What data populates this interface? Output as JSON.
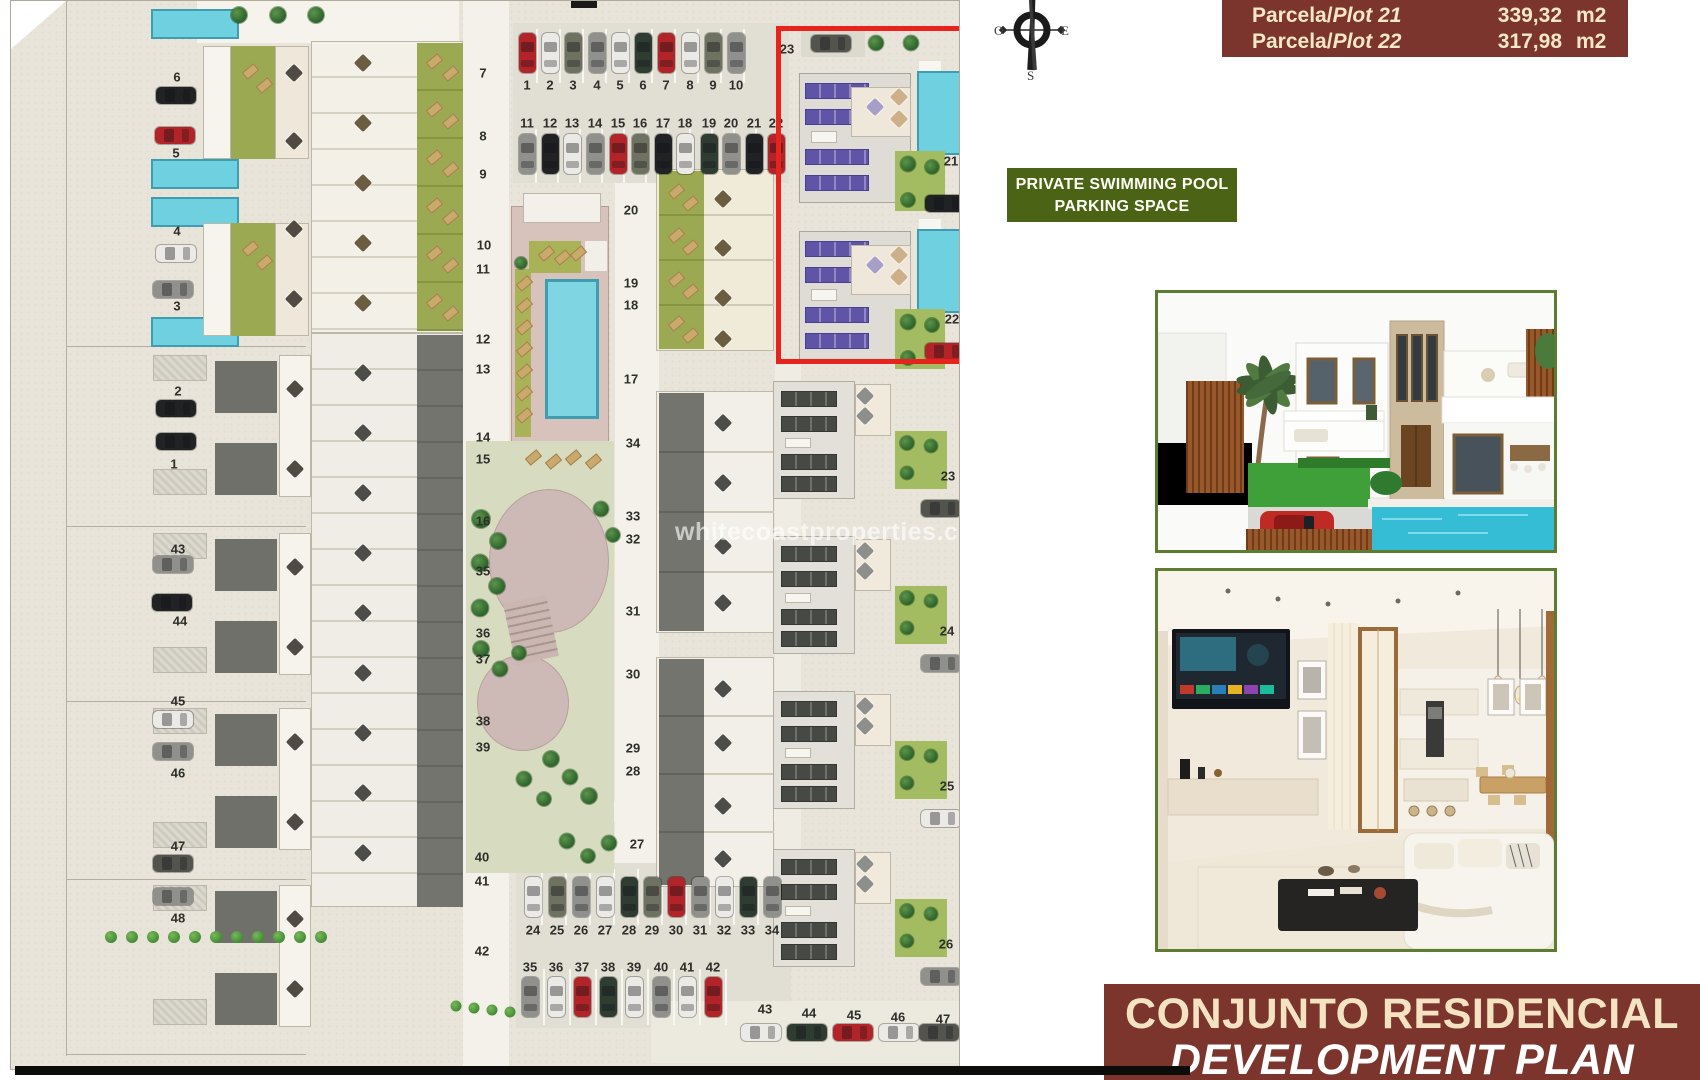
{
  "plot_table": {
    "bg": "#7b352c",
    "rows": [
      {
        "label_pre": "Parcela/",
        "label_plot": "Plot 21",
        "value": "339,32",
        "unit": "m2"
      },
      {
        "label_pre": "Parcela/",
        "label_plot": "Plot 22",
        "value": "317,98",
        "unit": "m2"
      }
    ]
  },
  "compass": {
    "west": "O",
    "east": "E",
    "south": "S"
  },
  "amenity_label": {
    "line1": "PRIVATE SWIMMING POOL",
    "line2": "PARKING SPACE",
    "bg": "#4a6315"
  },
  "banner": {
    "line1": "CONJUNTO RESIDENCIAL",
    "line2": "DEVELOPMENT PLAN",
    "bg": "#7b352c"
  },
  "watermark": "whitecoastproperties.co",
  "highlight_box": {
    "color": "#e8231e",
    "plots": "21-22"
  },
  "site_plan": {
    "plot_labels": [
      [
        "6",
        166,
        76
      ],
      [
        "5",
        165,
        152
      ],
      [
        "4",
        166,
        230
      ],
      [
        "3",
        166,
        305
      ],
      [
        "2",
        167,
        390
      ],
      [
        "1",
        163,
        463
      ],
      [
        "43",
        167,
        548
      ],
      [
        "44",
        169,
        620
      ],
      [
        "45",
        167,
        700
      ],
      [
        "46",
        167,
        772
      ],
      [
        "47",
        167,
        845
      ],
      [
        "48",
        167,
        917
      ],
      [
        "7",
        472,
        72
      ],
      [
        "8",
        472,
        135
      ],
      [
        "9",
        472,
        173
      ],
      [
        "10",
        473,
        244
      ],
      [
        "11",
        472,
        268
      ],
      [
        "12",
        472,
        338
      ],
      [
        "13",
        472,
        368
      ],
      [
        "14",
        472,
        436
      ],
      [
        "15",
        472,
        458
      ],
      [
        "16",
        472,
        520
      ],
      [
        "35",
        472,
        570
      ],
      [
        "36",
        472,
        632
      ],
      [
        "37",
        472,
        658
      ],
      [
        "38",
        472,
        720
      ],
      [
        "39",
        472,
        746
      ],
      [
        "40",
        471,
        856
      ],
      [
        "41",
        471,
        880
      ],
      [
        "42",
        471,
        950
      ],
      [
        "20",
        620,
        209
      ],
      [
        "19",
        620,
        282
      ],
      [
        "18",
        620,
        304
      ],
      [
        "17",
        620,
        378
      ],
      [
        "34",
        622,
        442
      ],
      [
        "33",
        622,
        515
      ],
      [
        "32",
        622,
        538
      ],
      [
        "31",
        622,
        610
      ],
      [
        "30",
        622,
        673
      ],
      [
        "29",
        622,
        747
      ],
      [
        "28",
        622,
        770
      ],
      [
        "27",
        626,
        843
      ],
      [
        "23",
        776,
        48
      ],
      [
        "21",
        940,
        160
      ],
      [
        "22",
        941,
        318
      ],
      [
        "23",
        937,
        475
      ],
      [
        "24",
        936,
        630
      ],
      [
        "25",
        936,
        785
      ],
      [
        "26",
        935,
        943
      ],
      [
        "1",
        516,
        84
      ],
      [
        "2",
        539,
        84
      ],
      [
        "3",
        562,
        84
      ],
      [
        "4",
        586,
        84
      ],
      [
        "5",
        609,
        84
      ],
      [
        "6",
        632,
        84
      ],
      [
        "7",
        655,
        84
      ],
      [
        "8",
        679,
        84
      ],
      [
        "9",
        702,
        84
      ],
      [
        "10",
        725,
        84
      ],
      [
        "11",
        516,
        122
      ],
      [
        "12",
        539,
        122
      ],
      [
        "13",
        561,
        122
      ],
      [
        "14",
        584,
        122
      ],
      [
        "15",
        607,
        122
      ],
      [
        "16",
        629,
        122
      ],
      [
        "17",
        652,
        122
      ],
      [
        "18",
        674,
        122
      ],
      [
        "19",
        698,
        122
      ],
      [
        "20",
        720,
        122
      ],
      [
        "21",
        743,
        122
      ],
      [
        "22",
        765,
        122
      ],
      [
        "24",
        522,
        929
      ],
      [
        "25",
        546,
        929
      ],
      [
        "26",
        570,
        929
      ],
      [
        "27",
        594,
        929
      ],
      [
        "28",
        618,
        929
      ],
      [
        "29",
        641,
        929
      ],
      [
        "30",
        665,
        929
      ],
      [
        "31",
        689,
        929
      ],
      [
        "32",
        713,
        929
      ],
      [
        "33",
        737,
        929
      ],
      [
        "34",
        761,
        929
      ],
      [
        "35",
        519,
        966
      ],
      [
        "36",
        545,
        966
      ],
      [
        "37",
        571,
        966
      ],
      [
        "38",
        597,
        966
      ],
      [
        "39",
        623,
        966
      ],
      [
        "40",
        650,
        966
      ],
      [
        "41",
        676,
        966
      ],
      [
        "42",
        702,
        966
      ],
      [
        "43",
        754,
        1008
      ],
      [
        "44",
        798,
        1012
      ],
      [
        "45",
        843,
        1014
      ],
      [
        "46",
        887,
        1016
      ],
      [
        "47",
        932,
        1018
      ]
    ],
    "cars": [
      [
        516,
        52,
        "v",
        "red"
      ],
      [
        539,
        52,
        "v",
        "white"
      ],
      [
        562,
        52,
        "v",
        "olive"
      ],
      [
        586,
        52,
        "v",
        "grey"
      ],
      [
        609,
        52,
        "v",
        "white"
      ],
      [
        632,
        52,
        "v",
        "green"
      ],
      [
        655,
        52,
        "v",
        "red"
      ],
      [
        679,
        52,
        "v",
        "white"
      ],
      [
        702,
        52,
        "v",
        "olive"
      ],
      [
        725,
        52,
        "v",
        "grey"
      ],
      [
        516,
        153,
        "v",
        "grey"
      ],
      [
        539,
        153,
        "v",
        "black"
      ],
      [
        561,
        153,
        "v",
        "white"
      ],
      [
        584,
        153,
        "v",
        "grey"
      ],
      [
        607,
        153,
        "v",
        "red"
      ],
      [
        629,
        153,
        "v",
        "olive"
      ],
      [
        652,
        153,
        "v",
        "black"
      ],
      [
        674,
        153,
        "v",
        "white"
      ],
      [
        698,
        153,
        "v",
        "green"
      ],
      [
        720,
        153,
        "v",
        "grey"
      ],
      [
        743,
        153,
        "v",
        "black"
      ],
      [
        765,
        153,
        "v",
        "red"
      ],
      [
        522,
        896,
        "v",
        "white"
      ],
      [
        546,
        896,
        "v",
        "olive"
      ],
      [
        570,
        896,
        "v",
        "grey"
      ],
      [
        594,
        896,
        "v",
        "white"
      ],
      [
        618,
        896,
        "v",
        "green"
      ],
      [
        641,
        896,
        "v",
        "olive"
      ],
      [
        665,
        896,
        "v",
        "red"
      ],
      [
        689,
        896,
        "v",
        "grey"
      ],
      [
        713,
        896,
        "v",
        "white"
      ],
      [
        737,
        896,
        "v",
        "green"
      ],
      [
        761,
        896,
        "v",
        "grey"
      ],
      [
        519,
        996,
        "v",
        "grey"
      ],
      [
        545,
        996,
        "v",
        "white"
      ],
      [
        571,
        996,
        "v",
        "red"
      ],
      [
        597,
        996,
        "v",
        "green"
      ],
      [
        623,
        996,
        "v",
        "white"
      ],
      [
        650,
        996,
        "v",
        "grey"
      ],
      [
        676,
        996,
        "v",
        "white"
      ],
      [
        702,
        996,
        "v",
        "red"
      ],
      [
        750,
        1031,
        "h",
        "white"
      ],
      [
        796,
        1031,
        "h",
        "green"
      ],
      [
        842,
        1031,
        "h",
        "red"
      ],
      [
        888,
        1031,
        "h",
        "white"
      ],
      [
        928,
        1031,
        "h",
        "dark"
      ],
      [
        165,
        94,
        "h",
        "black"
      ],
      [
        164,
        134,
        "h",
        "red"
      ],
      [
        165,
        252,
        "h",
        "white"
      ],
      [
        162,
        288,
        "h",
        "grey"
      ],
      [
        165,
        407,
        "h",
        "black"
      ],
      [
        165,
        440,
        "h",
        "black"
      ],
      [
        162,
        563,
        "h",
        "grey"
      ],
      [
        161,
        601,
        "h",
        "black"
      ],
      [
        162,
        718,
        "h",
        "white"
      ],
      [
        162,
        750,
        "h",
        "grey"
      ],
      [
        162,
        862,
        "h",
        "dark"
      ],
      [
        162,
        895,
        "h",
        "grey"
      ],
      [
        820,
        42,
        "h",
        "dark"
      ],
      [
        934,
        202,
        "h",
        "black"
      ],
      [
        934,
        350,
        "h",
        "red"
      ],
      [
        930,
        507,
        "h",
        "dark"
      ],
      [
        930,
        662,
        "h",
        "grey"
      ],
      [
        930,
        817,
        "h",
        "white"
      ],
      [
        930,
        975,
        "h",
        "grey"
      ]
    ]
  }
}
